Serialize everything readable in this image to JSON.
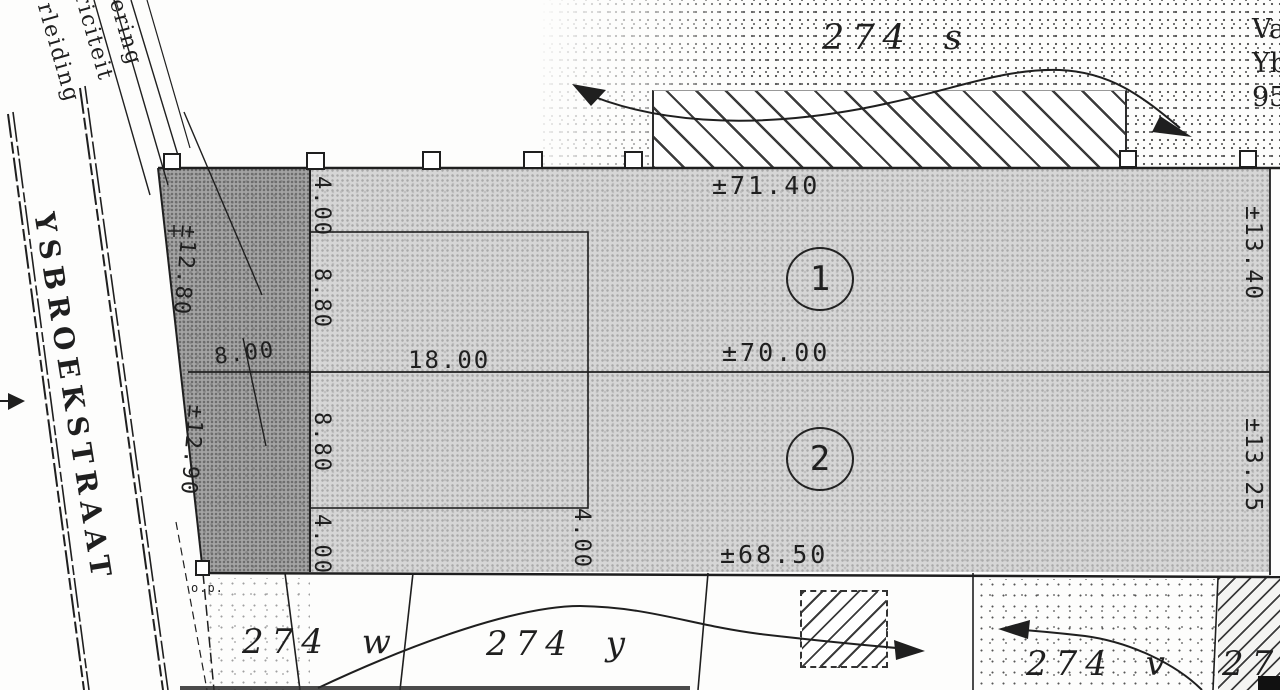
{
  "ink": "#1f1f1f",
  "street": {
    "name": "YSBROEKSTRAAT",
    "marker_note": "o.p."
  },
  "utilities": {
    "line1": "ering",
    "line2": "riciteit",
    "line3": "rleiding"
  },
  "edge_clipped": {
    "l1": "Va",
    "l2": "Yb",
    "l3": "95"
  },
  "parcels": {
    "top": "274 s",
    "w": "274 w",
    "y": "274 y",
    "v": "274 v",
    "corner": "274",
    "lot1": "1",
    "lot2": "2"
  },
  "measurements": {
    "top_width": "±71.40",
    "mid_width": "±70.00",
    "bottom_width": "±68.50",
    "left_upper": "±12.80",
    "left_lower": "±12.90",
    "left_diag": "8.00",
    "right_upper": "±13.40",
    "right_lower": "±13.25",
    "rect_width": "18.00",
    "seg_top": "4.00",
    "seg_upper": "8.80",
    "seg_lower": "8.80",
    "seg_bottom": "4.00",
    "rect_right": "4.00"
  }
}
